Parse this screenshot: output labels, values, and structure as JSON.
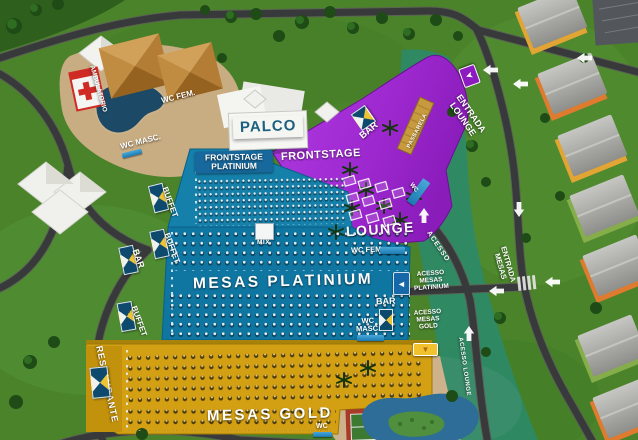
{
  "zones": {
    "palco": "PALCO",
    "frontstage_platinium": "FRONTSTAGE PLATINIUM",
    "frontstage": "FRONTSTAGE",
    "lounge": "LOUNGE",
    "mesas_platinium": "MESAS PLATINIUM",
    "mesas_gold": "MESAS GOLD",
    "restaurante": "RESTAURANTE",
    "passarela": "PASSARELA",
    "mix_booth": "MIX"
  },
  "services": {
    "ambulatorio": "AMBULATORIO",
    "wc_fem_top": "WC FEM.",
    "wc_masc_top": "WC MASC.",
    "wc_fem_platinium": "WC FEM.",
    "wc_masc_platinium": "WC MASC.",
    "wc_lounge": "WC",
    "wc_gold": "WC",
    "bar_lounge": "BAR",
    "bar_left": "BAR",
    "bar_platinium": "BAR",
    "buffet_top": "BUFFET",
    "buffet_mid": "BUFFET",
    "buffet_low": "BUFFET"
  },
  "access": {
    "entrada_lounge": "ENTRADA LOUNGE",
    "entrada_mesas": "ENTRADA MESAS",
    "acesso": "ACESSO",
    "acesso_mesas_platinium": "ACESSO MESAS PLATINIUM",
    "acesso_mesas_gold": "ACESSO MESAS GOLD",
    "acesso_lounge": "ACESSO LOUNGE"
  },
  "signs": {
    "left_arrow": "◄",
    "down_arrow": "▼",
    "flag_arrow": "➤"
  },
  "colors": {
    "grass": "#4a832a",
    "water": "#2c8a68",
    "road": "#37393b",
    "lounge_purple": "#a02ad2",
    "platinium_blue": "#0f76a2",
    "gold": "#d4a013",
    "sand": "#c9ad82",
    "palco_text": "#1c6080"
  }
}
